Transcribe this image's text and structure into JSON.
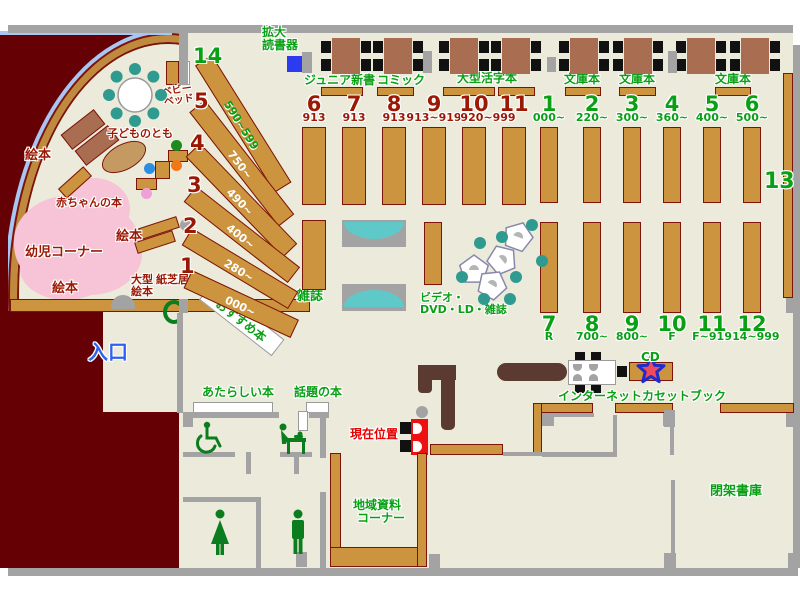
{
  "top_area": {
    "magnifier_line1": "拡大",
    "magnifier_line2": "読書器",
    "junior_shinsho": "ジュニア新書",
    "comic": "コミック",
    "large_print": "大型活字本",
    "bunko_1": "文庫本",
    "bunko_2": "文庫本",
    "bunko_3": "文庫本"
  },
  "kids_area": {
    "ehon_top": "絵本",
    "ehon_mid": "絵本",
    "ehon_bottom": "絵本",
    "baby_books": "赤ちゃんの本",
    "toddler_corner": "幼児コーナー",
    "kodomonotomo": "子どものとも",
    "baby_bed_line1": "ベビー",
    "baby_bed_line2": "ベッド",
    "large_picture_line1": "大型",
    "large_picture_line2": "絵本",
    "kamishibai": "紙芝居"
  },
  "entrance": {
    "label": "入口"
  },
  "fan_shelves": [
    {
      "num": "14",
      "range": "590~599"
    },
    {
      "num": "5",
      "range": "750~"
    },
    {
      "num": "4",
      "range": "490~"
    },
    {
      "num": "3",
      "range": "400~"
    },
    {
      "num": "2",
      "range": "280~"
    },
    {
      "num": "1",
      "range": "000~"
    }
  ],
  "red_columns": [
    {
      "num": "6",
      "range": "913"
    },
    {
      "num": "7",
      "range": "913"
    },
    {
      "num": "8",
      "range": "913"
    },
    {
      "num": "9",
      "range": "913~919"
    },
    {
      "num": "10",
      "range": "920~999"
    },
    {
      "num": "11",
      "range": ""
    }
  ],
  "green_columns": [
    {
      "num": "1",
      "range": "000~"
    },
    {
      "num": "2",
      "range": "220~"
    },
    {
      "num": "3",
      "range": "300~"
    },
    {
      "num": "4",
      "range": "360~"
    },
    {
      "num": "5",
      "range": "400~"
    },
    {
      "num": "6",
      "range": "500~"
    }
  ],
  "lower_columns": [
    {
      "num": "7",
      "range": "R"
    },
    {
      "num": "8",
      "range": "700~"
    },
    {
      "num": "9",
      "range": "800~"
    },
    {
      "num": "10",
      "range": "F"
    },
    {
      "num": "11",
      "range": "F~914"
    },
    {
      "num": "12",
      "range": "914~999"
    }
  ],
  "shelf13_label": "13",
  "center_labels": {
    "magazines": "雑誌",
    "video_line1": "ビデオ・",
    "video_line2": "DVD・LD・雑誌",
    "recommended": "おすすめ本",
    "new_books": "あたらしい本",
    "topic_books": "話題の本"
  },
  "services": {
    "internet": "インターネット",
    "cd": "CD",
    "cassette_books": "カセットブック",
    "local_docs_line1": "地域資料",
    "local_docs_line2": "コーナー",
    "closed_stacks": "閉架書庫",
    "current_location": "現在位置"
  },
  "colors": {
    "floor": "#ecebdb",
    "outside": "#650104",
    "wall": "#a3a3a3",
    "shelf": "#cd9440",
    "shelf_outline": "#7c1408",
    "table": "#a96e52",
    "counter": "#5b3a31",
    "teal_chair": "#2f9a8f",
    "bench_cyan": "#5fc9c9",
    "kids_pink": "#f7c3d6",
    "curve_blue": "#a8c6f4",
    "text_green": "#0aa016",
    "text_dark_red": "#9b1804",
    "text_red": "#e60000",
    "text_blue": "#2f62ee",
    "star_fill": "#ef4b5e",
    "star_stroke": "#1f2ccc"
  }
}
